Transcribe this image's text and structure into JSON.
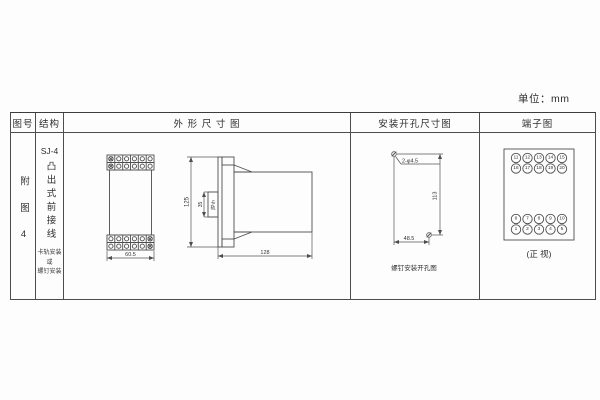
{
  "unit_label": "单位：mm",
  "colors": {
    "line": "#4d4d4d",
    "text": "#333333",
    "background": "#fdfdfd"
  },
  "table": {
    "headers": {
      "fig_no": "图号",
      "structure": "结构",
      "outline": "外 形 尺 寸 图",
      "mounting": "安装开孔尺寸图",
      "terminal": "端子图"
    }
  },
  "fig_no": {
    "label": "附图4"
  },
  "structure": {
    "model": "SJ-4",
    "wiring": "凸出式前接线",
    "note_line1": "卡轨安装",
    "note_line2": "或",
    "note_line3": "螺钉安装"
  },
  "outline_drawing": {
    "front_width": "60.5",
    "overall_height": "125",
    "rail_height": "35",
    "rail_label": "卡轨",
    "overall_depth": "128"
  },
  "mounting_drawing": {
    "hole_spec": "2-φ4.5",
    "vertical_spacing": "113",
    "horizontal_spacing": "48.5",
    "caption": "螺钉安装开孔图"
  },
  "terminal_diagram": {
    "top_row_1": [
      "11",
      "12",
      "13",
      "14",
      "15"
    ],
    "top_row_2": [
      "16",
      "17",
      "18",
      "19",
      "20"
    ],
    "bottom_row_1": [
      "6",
      "7",
      "8",
      "9",
      "10"
    ],
    "bottom_row_2": [
      "1",
      "2",
      "3",
      "4",
      "5"
    ],
    "caption": "(正 视)"
  }
}
